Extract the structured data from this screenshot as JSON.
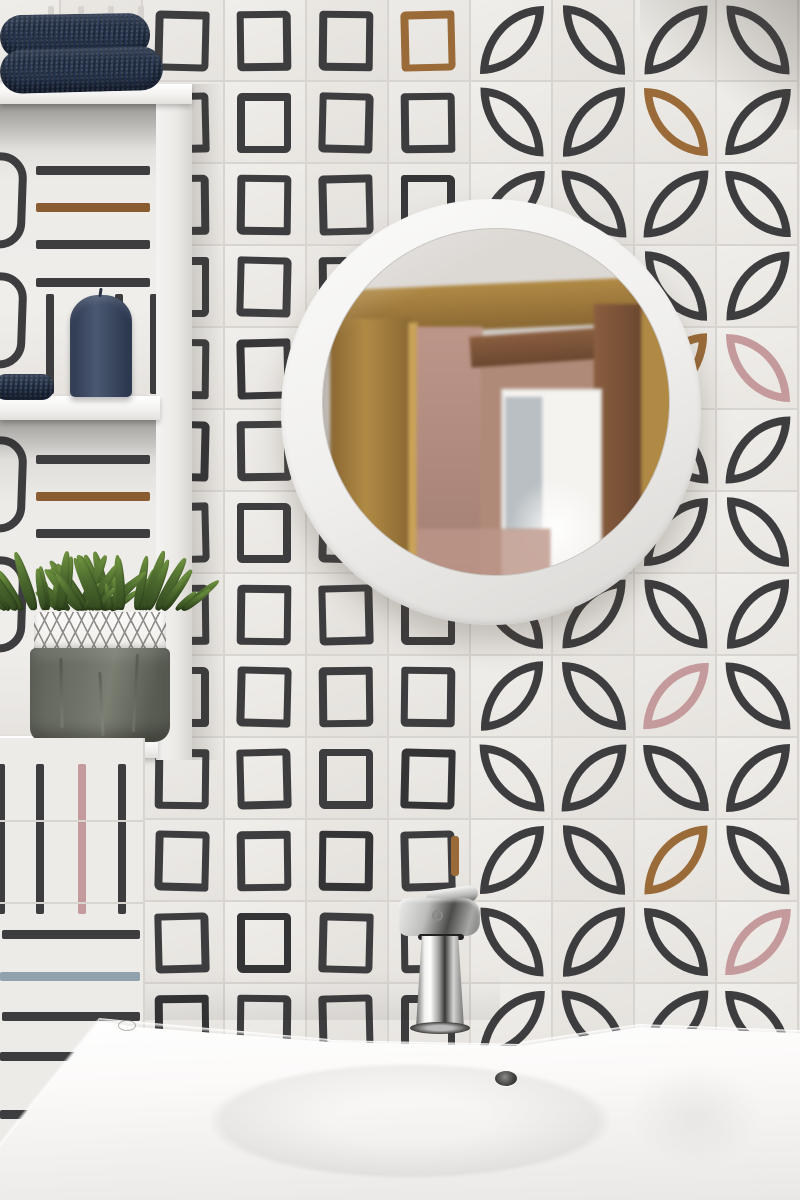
{
  "scene": {
    "description": "Bathroom wall with white hand-painted pattern tiles (marker-drawn squares, petal leaves and stripes), a round white-framed mirror reflecting an oak door frame, white open shelves on the left holding folded navy towels, a navy pillar candle and a green succulent in a grey paper-bag planter, above a white ceramic washbasin with a chrome single-lever mixer tap",
    "palette": {
      "wall_tile": "#edebe8",
      "wall_tile_alt": "#e8e5e2",
      "grout": "#d8d4d0",
      "ink": "#3d3c3e",
      "accent_brown": "#9a6a39",
      "accent_pink": "#c49a9c",
      "accent_blue": "#9fb3c3",
      "accent_sienna": "#8a5c31",
      "accent_bluegray": "#8fa2ad",
      "shelf_white": "#f3f2f0",
      "towel_navy": "#2c3a52",
      "towel_navy_dark": "#202e47",
      "plant_green_dark": "#33491f",
      "plant_green": "#4c6a2e",
      "plant_green_light": "#6f9440",
      "pot_gray": "#6e7166",
      "pot_band": "#efeeeb",
      "pot_lattice": "#8e8d89",
      "mirror_frame_shade": "#d9d7d4",
      "refl_base": "#cfc9c4",
      "refl_ceiling": "#dcd8d4",
      "oak": "#b08a45",
      "oak_dark": "#8a6833",
      "oak_light": "#c9a258",
      "pink_wall": "#bd968a",
      "door_brown": "#6b4730",
      "door_brown2": "#8a5e3f",
      "hall_pink": "#b08a78",
      "window_white": "#f5f3f0",
      "window_blue": "#b9bfc3",
      "sink_white": "#fbfaf9"
    },
    "tile_grid": {
      "rows": 15,
      "row_height": 82,
      "cols": [
        -21,
        61,
        143,
        225,
        307,
        389,
        471,
        553,
        635,
        717
      ],
      "square_col_start": 2,
      "leaf_col_start": 6,
      "square_accents": [
        {
          "col": 5,
          "row": 0,
          "mode": "full",
          "color": "brown"
        },
        {
          "col": 2,
          "row": 2,
          "mode": "bar-bottom",
          "color": "blue"
        },
        {
          "col": 2,
          "row": 8,
          "mode": "bar-bottom",
          "color": "pink"
        },
        {
          "col": 5,
          "row": 10,
          "mode": "bar-right",
          "color": "brown"
        }
      ],
      "leaf_accents": [
        {
          "col": 8,
          "row": 1,
          "color": "brown"
        },
        {
          "col": 8,
          "row": 4,
          "color": "brown"
        },
        {
          "col": 9,
          "row": 4,
          "color": "pink"
        },
        {
          "col": 7,
          "row": 5,
          "color": "brown"
        },
        {
          "col": 8,
          "row": 8,
          "color": "pink"
        },
        {
          "col": 8,
          "row": 10,
          "color": "brown"
        },
        {
          "col": 9,
          "row": 11,
          "color": "pink"
        }
      ]
    },
    "shelf_unit": {
      "niche1_hbars": [
        {
          "y": 166,
          "color": "ink"
        },
        {
          "y": 203,
          "color": "sienna"
        },
        {
          "y": 240,
          "color": "ink"
        },
        {
          "y": 278,
          "color": "ink"
        }
      ],
      "niche1_vbars": [
        {
          "x": 46,
          "color": "ink"
        },
        {
          "x": 115,
          "color": "ink"
        },
        {
          "x": 150,
          "color": "ink"
        }
      ],
      "niche2_hbars": [
        {
          "y": 455,
          "color": "ink"
        },
        {
          "y": 492,
          "color": "sienna"
        },
        {
          "y": 529,
          "color": "ink"
        }
      ]
    },
    "stripe_zone": {
      "vbars": [
        {
          "x": -3,
          "color": "ink"
        },
        {
          "x": 36,
          "color": "ink"
        },
        {
          "x": 78,
          "color": "pink"
        },
        {
          "x": 118,
          "color": "ink"
        }
      ],
      "hbars": [
        {
          "y": 930,
          "x": 2,
          "w": 138,
          "color": "ink"
        },
        {
          "y": 972,
          "x": 0,
          "w": 140,
          "color": "bluegray"
        },
        {
          "y": 1012,
          "x": 2,
          "w": 138,
          "color": "ink"
        },
        {
          "y": 1052,
          "x": 0,
          "w": 95,
          "color": "ink"
        },
        {
          "y": 1110,
          "x": 0,
          "w": 36,
          "color": "ink"
        }
      ]
    },
    "plant": {
      "leaf_count": 64
    },
    "objects": {
      "towels_top": {
        "label": "two folded navy towels",
        "count": 2
      },
      "towel_small": {
        "label": "navy towel on middle shelf"
      },
      "candle": {
        "label": "navy pillar candle"
      },
      "plant": {
        "label": "green succulent plant"
      },
      "planter": {
        "label": "grey paper-bag planter with white lattice trim"
      },
      "mirror": {
        "label": "round mirror with white frame"
      },
      "reflection": {
        "label": "oak door frame and bright window reflected in mirror"
      },
      "faucet": {
        "label": "chrome single-lever basin mixer"
      },
      "basin": {
        "label": "white ceramic washbasin with overflow hole"
      },
      "shelves": {
        "label": "white open shelving unit"
      }
    }
  }
}
